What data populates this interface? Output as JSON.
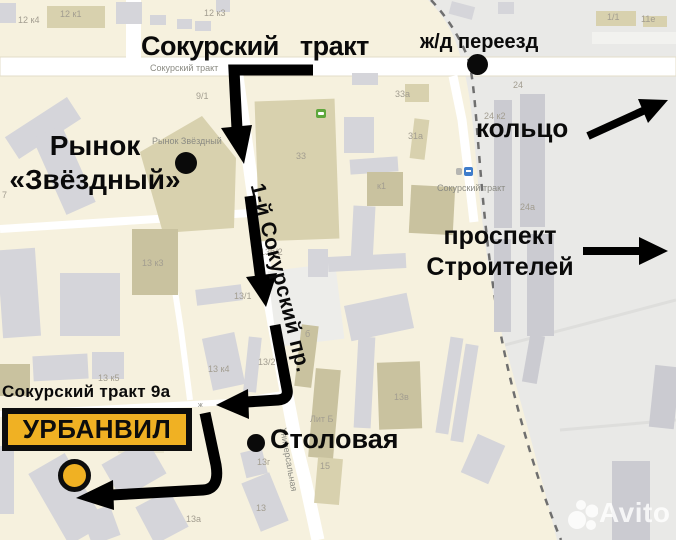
{
  "annotations": {
    "title": "Сокурский тракт",
    "railway_crossing": "ж/д переезд",
    "ring": "кольцо",
    "avenue_line1": "проспект",
    "avenue_line2": "Строителей",
    "market_line1": "Рынок",
    "market_line2": "«Звёздный»",
    "side_street": "1-й Сокурский пр.",
    "canteen": "Столовая",
    "address": "Сокурский тракт 9а",
    "brand_plate": "УРБАНВИЛ"
  },
  "map_labels": [
    "12 к4",
    "12 к1",
    "12 к3",
    "Сокурский тракт",
    "9/1",
    "33а",
    "1/1",
    "11е",
    "24",
    "24 к2",
    "24а",
    "Сокурский тракт",
    "Рынок Звёздный",
    "33",
    "31а",
    "к1",
    "13 к3",
    "13б/2",
    "13/1",
    "13/2",
    "13 к4",
    "13 к5",
    "13в",
    "Лит Б",
    "13г",
    "15",
    "13",
    "13а",
    "7",
    "Универсальная",
    "б",
    "ж"
  ],
  "watermark": {
    "brand": "Avito"
  },
  "colors": {
    "brand_yellow": "#f0b123",
    "route_black": "#000000",
    "map_background": "#f6f1de",
    "industrial_zone": "#e9e9e7"
  },
  "icons": [
    "supermarket-icon",
    "bus-stop-icon",
    "transit-stop-icon"
  ]
}
